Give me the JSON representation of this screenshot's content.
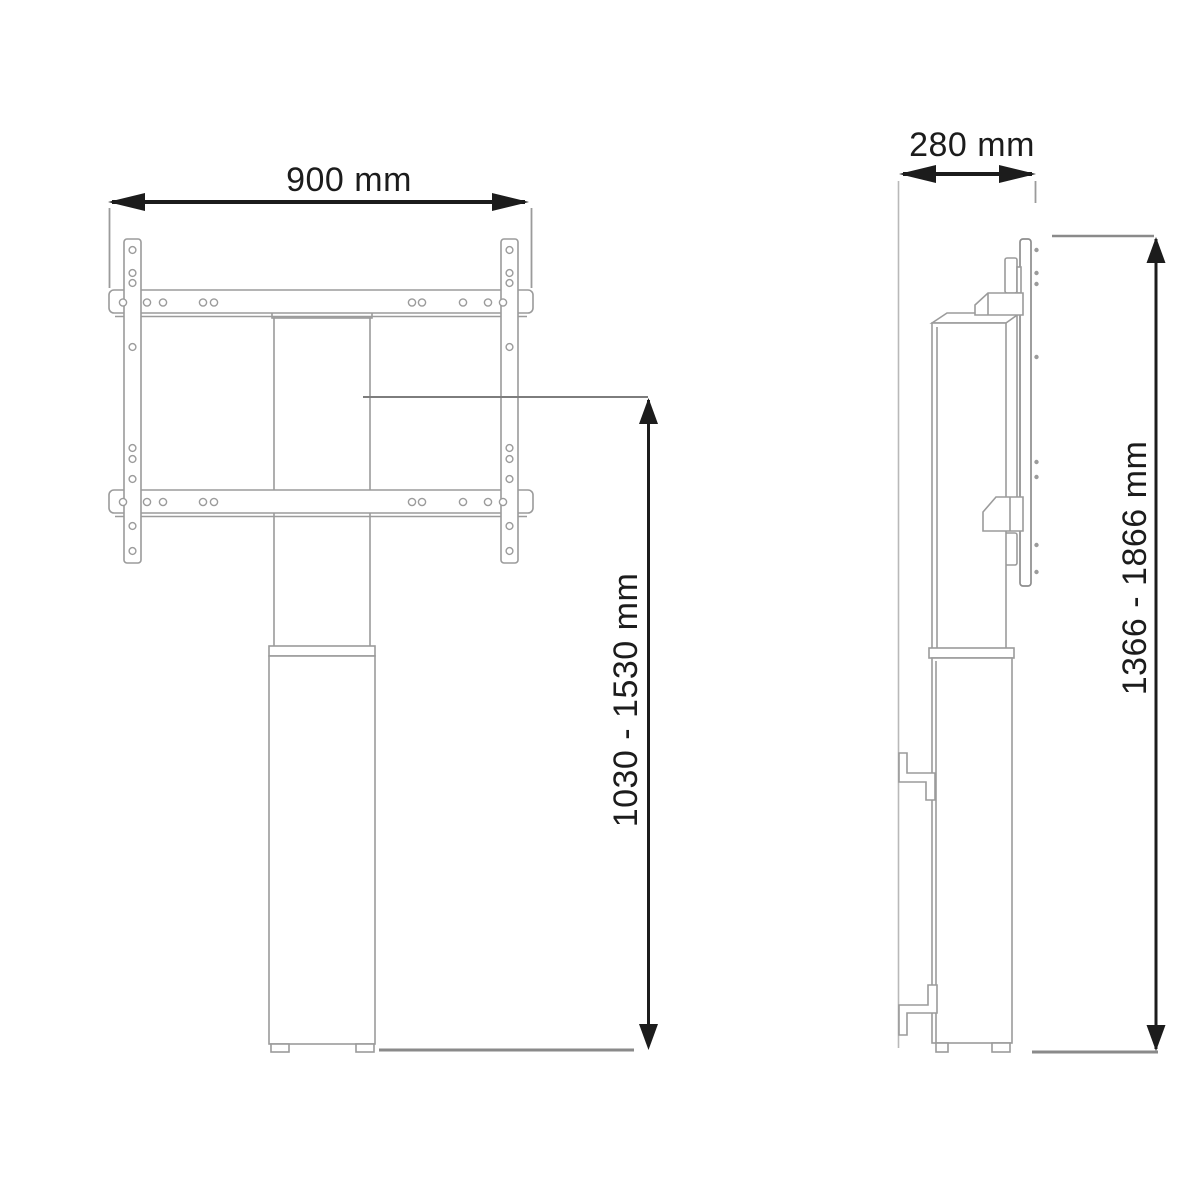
{
  "diagram": {
    "front_view": {
      "width_label": "900 mm",
      "height_label": "1030 - 1530 mm"
    },
    "side_view": {
      "depth_label": "280 mm",
      "height_label": "1366 - 1866 mm"
    },
    "colors": {
      "background": "#ffffff",
      "structure_outline": "#9b9b9b",
      "ground_line": "#8a8a8a",
      "dimension": "#1c1c1c"
    }
  }
}
